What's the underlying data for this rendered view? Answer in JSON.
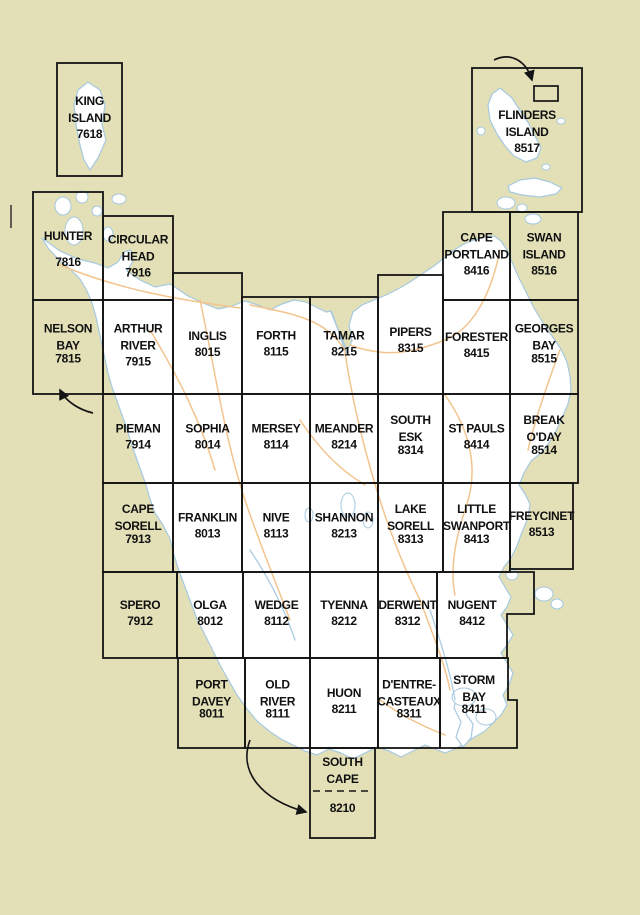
{
  "palette": {
    "sea": "#e3e0b8",
    "land": "#ffffff",
    "coastline": "#a6c9e0",
    "road": "#f2c48e",
    "grid": "#141414",
    "label_text": "#101010"
  },
  "sheets": [
    {
      "name": "King Island",
      "lines": [
        "KING",
        "ISLAND"
      ],
      "number": "7618",
      "x": 57,
      "y": 63,
      "w": 65,
      "h": 113
    },
    {
      "name": "Flinders Island",
      "lines": [
        "FLINDERS",
        "ISLAND"
      ],
      "number": "8517",
      "x": 472,
      "y": 68,
      "w": 110,
      "h": 144,
      "label_top": 119
    },
    {
      "name": "Hunter",
      "lines": [
        "HUNTER"
      ],
      "number": "7816",
      "x": 33,
      "y": 192,
      "w": 70,
      "h": 108,
      "number_gap": 26
    },
    {
      "name": "Circular Head",
      "lines": [
        "CIRCULAR",
        "HEAD"
      ],
      "number": "7916",
      "x": 103,
      "y": 216,
      "w": 70,
      "h": 84
    },
    {
      "name": "Cape Portland",
      "lines": [
        "CAPE",
        "PORTLAND"
      ],
      "number": "8416",
      "x": 443,
      "y": 212,
      "w": 67,
      "h": 88
    },
    {
      "name": "Swan Island",
      "lines": [
        "SWAN",
        "ISLAND"
      ],
      "number": "8516",
      "x": 510,
      "y": 212,
      "w": 68,
      "h": 88
    },
    {
      "name": "Nelson Bay",
      "lines": [
        "NELSON",
        "BAY"
      ],
      "number": "7815",
      "x": 33,
      "y": 300,
      "w": 70,
      "h": 94,
      "number_gap": 13
    },
    {
      "name": "Arthur River",
      "lines": [
        "ARTHUR",
        "RIVER"
      ],
      "number": "7915",
      "x": 103,
      "y": 300,
      "w": 70,
      "h": 94
    },
    {
      "name": "Inglis",
      "lines": [
        "INGLIS"
      ],
      "number": "8015",
      "x": 173,
      "y": 273,
      "w": 69,
      "h": 121,
      "label_top": 340
    },
    {
      "name": "Forth",
      "lines": [
        "FORTH"
      ],
      "number": "8115",
      "x": 242,
      "y": 297,
      "w": 68,
      "h": 97
    },
    {
      "name": "Tamar",
      "lines": [
        "TAMAR"
      ],
      "number": "8215",
      "x": 310,
      "y": 297,
      "w": 68,
      "h": 97
    },
    {
      "name": "Pipers",
      "lines": [
        "PIPERS"
      ],
      "number": "8315",
      "x": 378,
      "y": 275,
      "w": 65,
      "h": 119,
      "label_top": 336
    },
    {
      "name": "Forester",
      "lines": [
        "FORESTER"
      ],
      "number": "8415",
      "x": 443,
      "y": 300,
      "w": 67,
      "h": 94
    },
    {
      "name": "Georges Bay",
      "lines": [
        "GEORGES",
        "BAY"
      ],
      "number": "8515",
      "x": 510,
      "y": 300,
      "w": 68,
      "h": 94,
      "number_gap": 13
    },
    {
      "name": "Pieman",
      "lines": [
        "PIEMAN"
      ],
      "number": "7914",
      "x": 103,
      "y": 394,
      "w": 70,
      "h": 89
    },
    {
      "name": "Sophia",
      "lines": [
        "SOPHIA"
      ],
      "number": "8014",
      "x": 173,
      "y": 394,
      "w": 69,
      "h": 89
    },
    {
      "name": "Mersey",
      "lines": [
        "MERSEY"
      ],
      "number": "8114",
      "x": 242,
      "y": 394,
      "w": 68,
      "h": 89
    },
    {
      "name": "Meander",
      "lines": [
        "MEANDER"
      ],
      "number": "8214",
      "x": 310,
      "y": 394,
      "w": 68,
      "h": 89
    },
    {
      "name": "South Esk",
      "lines": [
        "SOUTH",
        "ESK"
      ],
      "number": "8314",
      "x": 378,
      "y": 394,
      "w": 65,
      "h": 89,
      "number_gap": 13
    },
    {
      "name": "St Pauls",
      "lines": [
        "ST PAULS"
      ],
      "number": "8414",
      "x": 443,
      "y": 394,
      "w": 67,
      "h": 89
    },
    {
      "name": "Break O'Day",
      "lines": [
        "BREAK",
        "O'DAY"
      ],
      "number": "8514",
      "x": 510,
      "y": 394,
      "w": 68,
      "h": 89,
      "number_gap": 13
    },
    {
      "name": "Cape Sorell",
      "lines": [
        "CAPE",
        "SORELL"
      ],
      "number": "7913",
      "x": 103,
      "y": 483,
      "w": 70,
      "h": 89,
      "number_gap": 13
    },
    {
      "name": "Franklin",
      "lines": [
        "FRANKLIN"
      ],
      "number": "8013",
      "x": 173,
      "y": 483,
      "w": 69,
      "h": 89
    },
    {
      "name": "Nive",
      "lines": [
        "NIVE"
      ],
      "number": "8113",
      "x": 242,
      "y": 483,
      "w": 68,
      "h": 89
    },
    {
      "name": "Shannon",
      "lines": [
        "SHANNON"
      ],
      "number": "8213",
      "x": 310,
      "y": 483,
      "w": 68,
      "h": 89
    },
    {
      "name": "Lake Sorell",
      "lines": [
        "LAKE",
        "SORELL"
      ],
      "number": "8313",
      "x": 378,
      "y": 483,
      "w": 65,
      "h": 89,
      "number_gap": 13
    },
    {
      "name": "Little Swanport",
      "lines": [
        "LITTLE",
        "SWANPORT"
      ],
      "number": "8413",
      "x": 443,
      "y": 483,
      "w": 67,
      "h": 89,
      "number_gap": 13
    },
    {
      "name": "Freycinet",
      "lines": [
        "FREYCINET"
      ],
      "number": "8513",
      "x": 510,
      "y": 483,
      "w": 63,
      "h": 86
    },
    {
      "name": "Spero",
      "lines": [
        "SPERO"
      ],
      "number": "7912",
      "x": 103,
      "y": 572,
      "w": 74,
      "h": 86
    },
    {
      "name": "Olga",
      "lines": [
        "OLGA"
      ],
      "number": "8012",
      "x": 177,
      "y": 572,
      "w": 66,
      "h": 86
    },
    {
      "name": "Wedge",
      "lines": [
        "WEDGE"
      ],
      "number": "8112",
      "x": 243,
      "y": 572,
      "w": 67,
      "h": 86
    },
    {
      "name": "Tyenna",
      "lines": [
        "TYENNA"
      ],
      "number": "8212",
      "x": 310,
      "y": 572,
      "w": 68,
      "h": 86
    },
    {
      "name": "Derwent",
      "lines": [
        "DERWENT"
      ],
      "number": "8312",
      "x": 378,
      "y": 572,
      "w": 59,
      "h": 86
    },
    {
      "name": "Nugent",
      "lines": [
        "NUGENT"
      ],
      "number": "8412",
      "x": 437,
      "y": 572,
      "w": 70,
      "h": 86,
      "path": "M437,572 L534,572 L534,614 L507,614 L507,658 L437,658 Z"
    },
    {
      "name": "Port Davey",
      "lines": [
        "PORT",
        "DAVEY"
      ],
      "number": "8011",
      "x": 178,
      "y": 658,
      "w": 67,
      "h": 90,
      "number_gap": 12
    },
    {
      "name": "Old River",
      "lines": [
        "OLD",
        "RIVER"
      ],
      "number": "8111",
      "x": 245,
      "y": 658,
      "w": 65,
      "h": 90,
      "number_gap": 12
    },
    {
      "name": "Huon",
      "lines": [
        "HUON"
      ],
      "number": "8211",
      "x": 310,
      "y": 658,
      "w": 68,
      "h": 90
    },
    {
      "name": "D'Entre-Casteaux",
      "lines": [
        "D'ENTRE-",
        "CASTEAUX"
      ],
      "number": "8311",
      "x": 378,
      "y": 658,
      "w": 62,
      "h": 90,
      "number_gap": 12
    },
    {
      "name": "Storm Bay",
      "lines": [
        "STORM",
        "BAY"
      ],
      "number": "8411",
      "x": 440,
      "y": 658,
      "w": 68,
      "h": 90,
      "path": "M440,658 L508,658 L508,700 L517,700 L517,748 L440,748 Z",
      "label_top": 684,
      "number_gap": 12
    },
    {
      "name": "South Cape",
      "lines": [
        "SOUTH",
        "CAPE"
      ],
      "number": "8210",
      "x": 310,
      "y": 748,
      "w": 65,
      "h": 90,
      "label_top": 766,
      "number_y": 812,
      "dash_y": 791
    }
  ]
}
